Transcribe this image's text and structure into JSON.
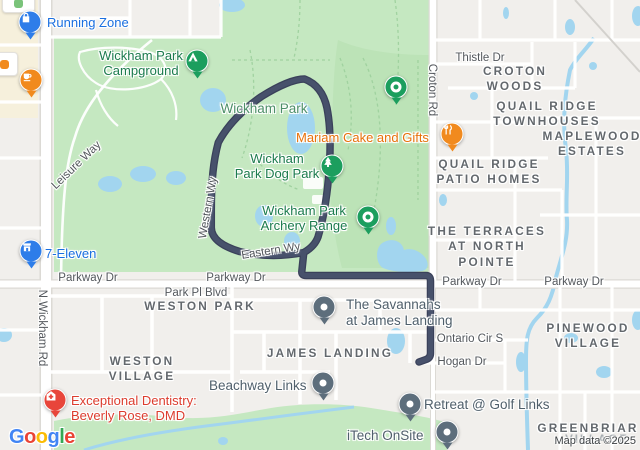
{
  "map": {
    "colors": {
      "urban": "#f1efec",
      "beige": "#f6f0dc",
      "park": "#c5e8c1",
      "park_dark": "#b3ddae",
      "water": "#a2d5ef",
      "road_casing": "#dcdad5",
      "route": "#47516b",
      "route_casing": "#3a415a"
    },
    "labels": [
      {
        "id": "running-zone",
        "text": "Running Zone",
        "type": "poi-blue",
        "x": 47,
        "y": 15,
        "anchor": "tl"
      },
      {
        "id": "wickham-park-campground",
        "text": "Wickham Park\nCampground",
        "type": "poi-green",
        "x": 141,
        "y": 48,
        "anchor": "tc"
      },
      {
        "id": "wickham-park",
        "text": "Wickham Park",
        "type": "park-name",
        "x": 264,
        "y": 101,
        "anchor": "tc"
      },
      {
        "id": "mariam-cake-and-gifts",
        "text": "Mariam Cake and Gifts",
        "type": "poi-orange",
        "x": 296,
        "y": 130,
        "anchor": "tl"
      },
      {
        "id": "wickham-park-dog-park",
        "text": "Wickham\nPark Dog Park",
        "type": "poi-green",
        "x": 277,
        "y": 151,
        "anchor": "tc"
      },
      {
        "id": "wickham-park-archery-range",
        "text": "Wickham Park\nArchery Range",
        "type": "poi-green",
        "x": 304,
        "y": 203,
        "anchor": "tc"
      },
      {
        "id": "seven-eleven",
        "text": "7-Eleven",
        "type": "poi-blue",
        "x": 45,
        "y": 246,
        "anchor": "tl"
      },
      {
        "id": "the-savannahs",
        "text": "The Savannahs\nat James Landing",
        "type": "poi-slate",
        "x": 346,
        "y": 297,
        "anchor": "tl"
      },
      {
        "id": "beachway-links",
        "text": "Beachway Links",
        "type": "poi-slate",
        "x": 209,
        "y": 378,
        "anchor": "tl"
      },
      {
        "id": "retreat-at-golf-links",
        "text": "Retreat @ Golf Links",
        "type": "poi-slate",
        "x": 424,
        "y": 397,
        "anchor": "tl"
      },
      {
        "id": "itech-onsite",
        "text": "iTech OnSite",
        "type": "poi-slate",
        "x": 347,
        "y": 428,
        "anchor": "tl"
      },
      {
        "id": "exceptional-dentistry",
        "text": "Exceptional Dentistry:\nBeverly Rose, DMD",
        "type": "poi-red",
        "x": 71,
        "y": 393,
        "anchor": "tl"
      },
      {
        "id": "croton-woods",
        "text": "CROTON WOODS",
        "type": "nb",
        "x": 515,
        "y": 64,
        "anchor": "tc"
      },
      {
        "id": "quail-ridge-townhouses",
        "text": "QUAIL RIDGE\nTOWNHOUSES",
        "type": "nb",
        "x": 547,
        "y": 99,
        "anchor": "tc"
      },
      {
        "id": "maplewood-estates",
        "text": "MAPLEWOOD\nESTATES",
        "type": "nb",
        "x": 592,
        "y": 129,
        "anchor": "tc"
      },
      {
        "id": "quail-ridge-patio-homes",
        "text": "QUAIL RIDGE\nPATIO HOMES",
        "type": "nb",
        "x": 489,
        "y": 157,
        "anchor": "tc"
      },
      {
        "id": "the-terraces-at-north-pointe",
        "text": "THE TERRACES\nAT NORTH\nPOINTE",
        "type": "nb",
        "x": 487,
        "y": 224,
        "anchor": "tc"
      },
      {
        "id": "weston-park",
        "text": "WESTON PARK",
        "type": "nb",
        "x": 200,
        "y": 299,
        "anchor": "tc"
      },
      {
        "id": "weston-village",
        "text": "WESTON\nVILLAGE",
        "type": "nb",
        "x": 142,
        "y": 354,
        "anchor": "tc"
      },
      {
        "id": "james-landing",
        "text": "JAMES LANDING",
        "type": "nb",
        "x": 330,
        "y": 346,
        "anchor": "tc"
      },
      {
        "id": "pinewood-village",
        "text": "PINEWOOD\nVILLAGE",
        "type": "nb",
        "x": 588,
        "y": 321,
        "anchor": "tc"
      },
      {
        "id": "greenbriar",
        "text": "GREENBRIAR",
        "type": "nb",
        "x": 588,
        "y": 421,
        "anchor": "tc"
      },
      {
        "id": "greenbriar-village",
        "text": "VILLAGE",
        "type": "nb-faint",
        "x": 597,
        "y": 434,
        "anchor": "tc"
      },
      {
        "id": "thistle-dr",
        "text": "Thistle Dr",
        "type": "road",
        "x": 480,
        "y": 52,
        "anchor": "tc"
      },
      {
        "id": "croton-rd",
        "text": "Croton Rd",
        "type": "road",
        "x": 431,
        "y": 90,
        "anchor": "c",
        "rot": 90
      },
      {
        "id": "parkway-dr-w",
        "text": "Parkway Dr",
        "type": "road",
        "x": 88,
        "y": 272,
        "anchor": "tc"
      },
      {
        "id": "parkway-dr-c",
        "text": "Parkway Dr",
        "type": "road",
        "x": 236,
        "y": 272,
        "anchor": "tc"
      },
      {
        "id": "parkway-dr-e1",
        "text": "Parkway Dr",
        "type": "road",
        "x": 472,
        "y": 276,
        "anchor": "tc"
      },
      {
        "id": "parkway-dr-e2",
        "text": "Parkway Dr",
        "type": "road",
        "x": 574,
        "y": 276,
        "anchor": "tc"
      },
      {
        "id": "park-pl-blvd",
        "text": "Park Pl Blvd",
        "type": "road",
        "x": 196,
        "y": 287,
        "anchor": "tc"
      },
      {
        "id": "ontario-cir-s",
        "text": "Ontario Cir S",
        "type": "road",
        "x": 470,
        "y": 333,
        "anchor": "tc"
      },
      {
        "id": "hogan-dr",
        "text": "Hogan Dr",
        "type": "road",
        "x": 462,
        "y": 356,
        "anchor": "tc"
      },
      {
        "id": "n-wickham-rd",
        "text": "N Wickham Rd",
        "type": "road",
        "x": 41,
        "y": 328,
        "anchor": "c",
        "rot": 90
      },
      {
        "id": "leisure-way",
        "text": "Leisure Way",
        "type": "road",
        "x": 77,
        "y": 166,
        "anchor": "c",
        "rot": -44
      },
      {
        "id": "western-wy",
        "text": "Western Wy",
        "type": "road",
        "x": 209,
        "y": 208,
        "anchor": "c",
        "rot": -80
      },
      {
        "id": "eastern-wy",
        "text": "Eastern Wy",
        "type": "road",
        "x": 271,
        "y": 252,
        "anchor": "c",
        "rot": -9
      }
    ],
    "pins": [
      {
        "id": "running-zone",
        "icon": "shopping-bag",
        "color": "#2e7de9",
        "x": 30,
        "y": 22
      },
      {
        "id": "coffee-shop",
        "icon": "coffee-cup",
        "color": "#f18a1e",
        "x": 31,
        "y": 80
      },
      {
        "id": "campground",
        "icon": "tent",
        "color": "#1c9e5e",
        "x": 197,
        "y": 61
      },
      {
        "id": "park-poi",
        "icon": "donut",
        "color": "#1c9e5e",
        "x": 396,
        "y": 87
      },
      {
        "id": "dog-park",
        "icon": "tree",
        "color": "#1c9e5e",
        "x": 332,
        "y": 166
      },
      {
        "id": "mariam-cake",
        "icon": "restaurant",
        "color": "#f18a1e",
        "x": 452,
        "y": 134
      },
      {
        "id": "archery-range",
        "icon": "donut",
        "color": "#1c9e5e",
        "x": 368,
        "y": 217
      },
      {
        "id": "seven-eleven",
        "icon": "store",
        "color": "#2e7de9",
        "x": 31,
        "y": 251
      },
      {
        "id": "the-savannahs",
        "icon": "dot",
        "color": "#5d6e7c",
        "x": 324,
        "y": 307
      },
      {
        "id": "beachway-links",
        "icon": "dot",
        "color": "#5d6e7c",
        "x": 323,
        "y": 383
      },
      {
        "id": "retreat-golf-links",
        "icon": "dot",
        "color": "#5d6e7c",
        "x": 410,
        "y": 404
      },
      {
        "id": "itech-onsite",
        "icon": "dot",
        "color": "#5d6e7c",
        "x": 447,
        "y": 432
      },
      {
        "id": "dentistry",
        "icon": "medical",
        "color": "#e8453a",
        "x": 55,
        "y": 400
      }
    ],
    "plaques": [
      {
        "id": "edge-poi-top-left",
        "x": 2,
        "y": -6,
        "w": 31,
        "h": 17,
        "glyph": "#7ac37a"
      },
      {
        "id": "edge-poi-left",
        "x": -10,
        "y": 52,
        "w": 26,
        "h": 22,
        "glyph": "#f18a1e"
      }
    ]
  },
  "attribution": {
    "map_data": "Map data ©2025",
    "logo_letters": [
      {
        "ch": "G",
        "color": "#4285F4"
      },
      {
        "ch": "o",
        "color": "#EA4335"
      },
      {
        "ch": "o",
        "color": "#FBBC04"
      },
      {
        "ch": "g",
        "color": "#4285F4"
      },
      {
        "ch": "l",
        "color": "#34A853"
      },
      {
        "ch": "e",
        "color": "#EA4335"
      }
    ]
  }
}
